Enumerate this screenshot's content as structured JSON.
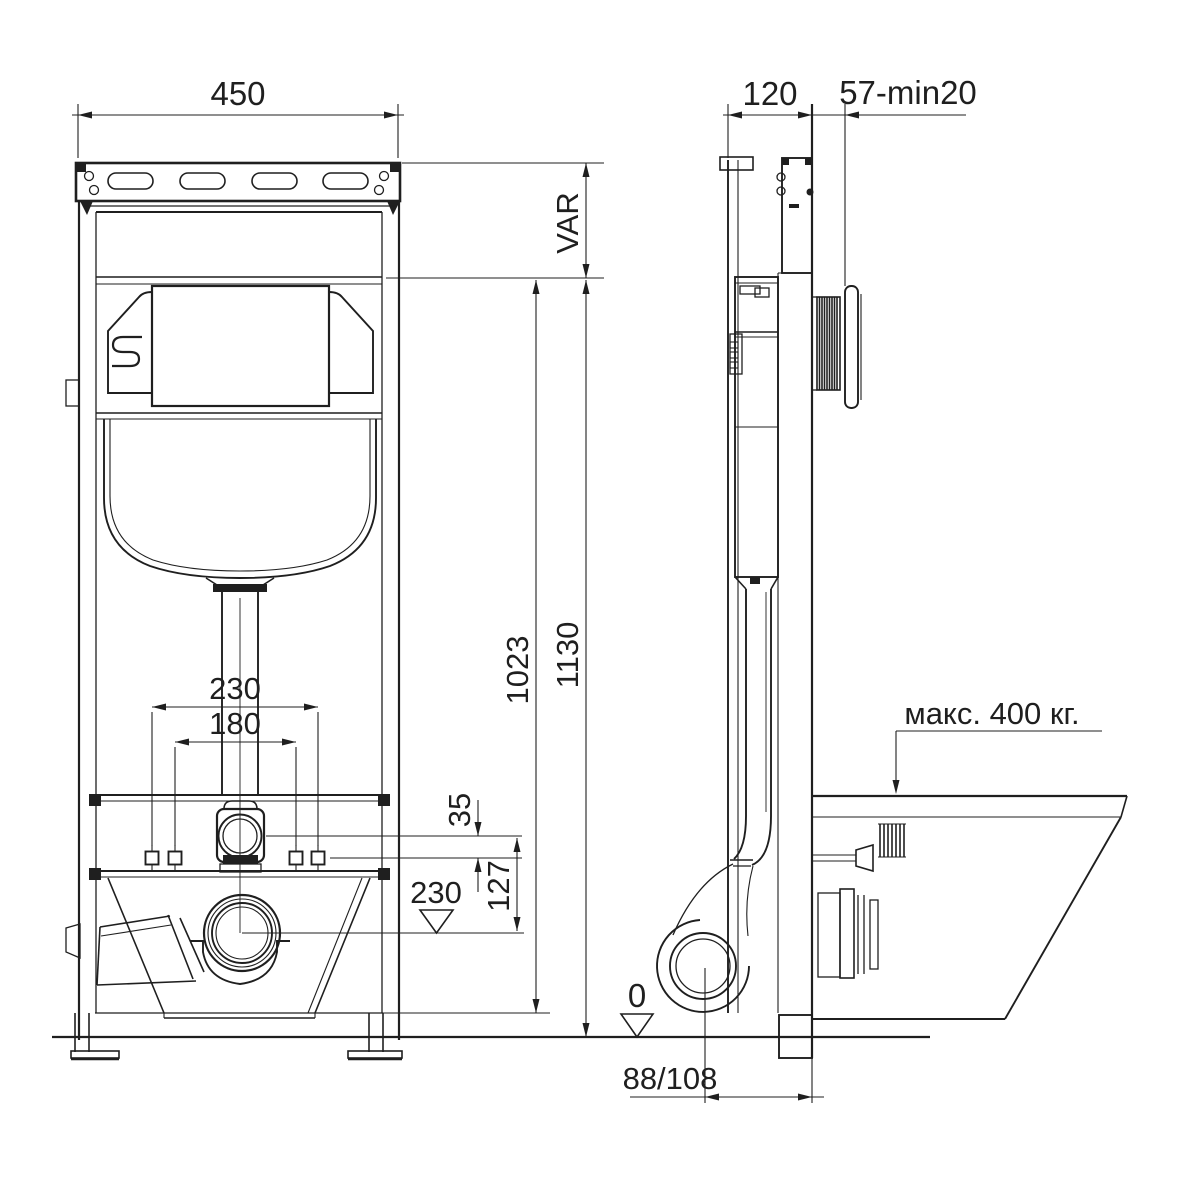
{
  "drawing": {
    "type": "technical-installation-diagram",
    "subject": "concealed WC cistern installation frame, front and side views",
    "background": "#ffffff",
    "line_color": "#1f1f1f"
  },
  "front_view": {
    "width": "450",
    "var_height": "VAR",
    "inner_height": "1023",
    "total_height": "1130",
    "fixing_outer": "230",
    "fixing_inner": "180",
    "offset_top": "35",
    "offset_mid": "127",
    "outlet_height": "230"
  },
  "side_view": {
    "depth": "120",
    "wall_range": "57-min20",
    "max_load": "макс. 400 кг.",
    "floor_level": "0",
    "outlet_offset": "88/108"
  }
}
